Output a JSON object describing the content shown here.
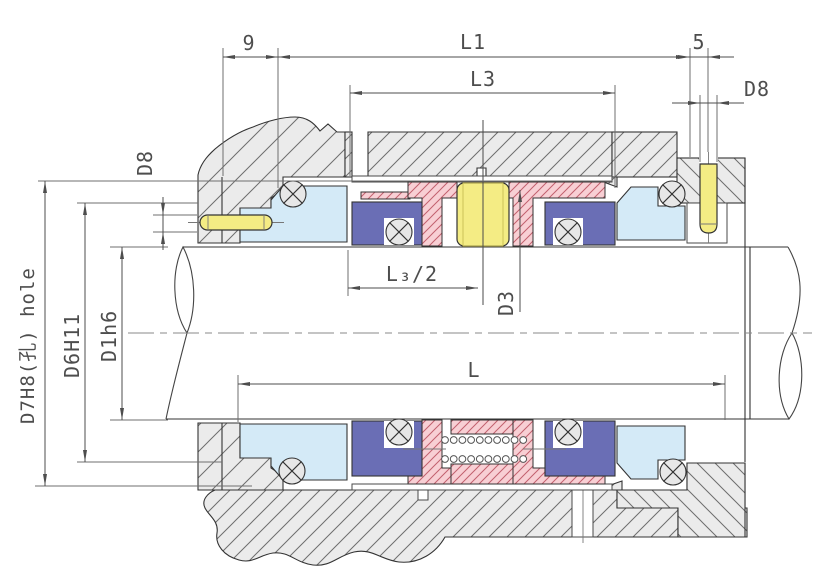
{
  "drawing": {
    "dims": {
      "d9": "9",
      "L1": "L1",
      "L3": "L3",
      "d5": "5",
      "D8_top": "D8",
      "D8_left": "D8",
      "D7H8": "D7H8(孔) hole",
      "D6H11": "D6H11",
      "D1h6": "D1h6",
      "L3_half": "L₃/2",
      "D3": "D3",
      "L": "L"
    },
    "colors": {
      "metal": "#ebebeb",
      "hatch_line": "#6e6e6e",
      "seat_blue": "#d4eaf7",
      "ring_blue": "#6a6eb5",
      "elastomer_pink": "#f8cfd4",
      "pink_line": "#c2606e",
      "spring_yellow": "#f4ec84",
      "outline": "#333333",
      "dim": "#4d4d4d"
    },
    "parts": [
      "stuffing-box-housing",
      "gland-plate",
      "shaft",
      "shaft-sleeve",
      "stationary-seat",
      "rotary-seal-ring",
      "o-ring",
      "spring",
      "elastomer-bellows",
      "anti-rotation-pin",
      "set-screw-pin"
    ]
  }
}
